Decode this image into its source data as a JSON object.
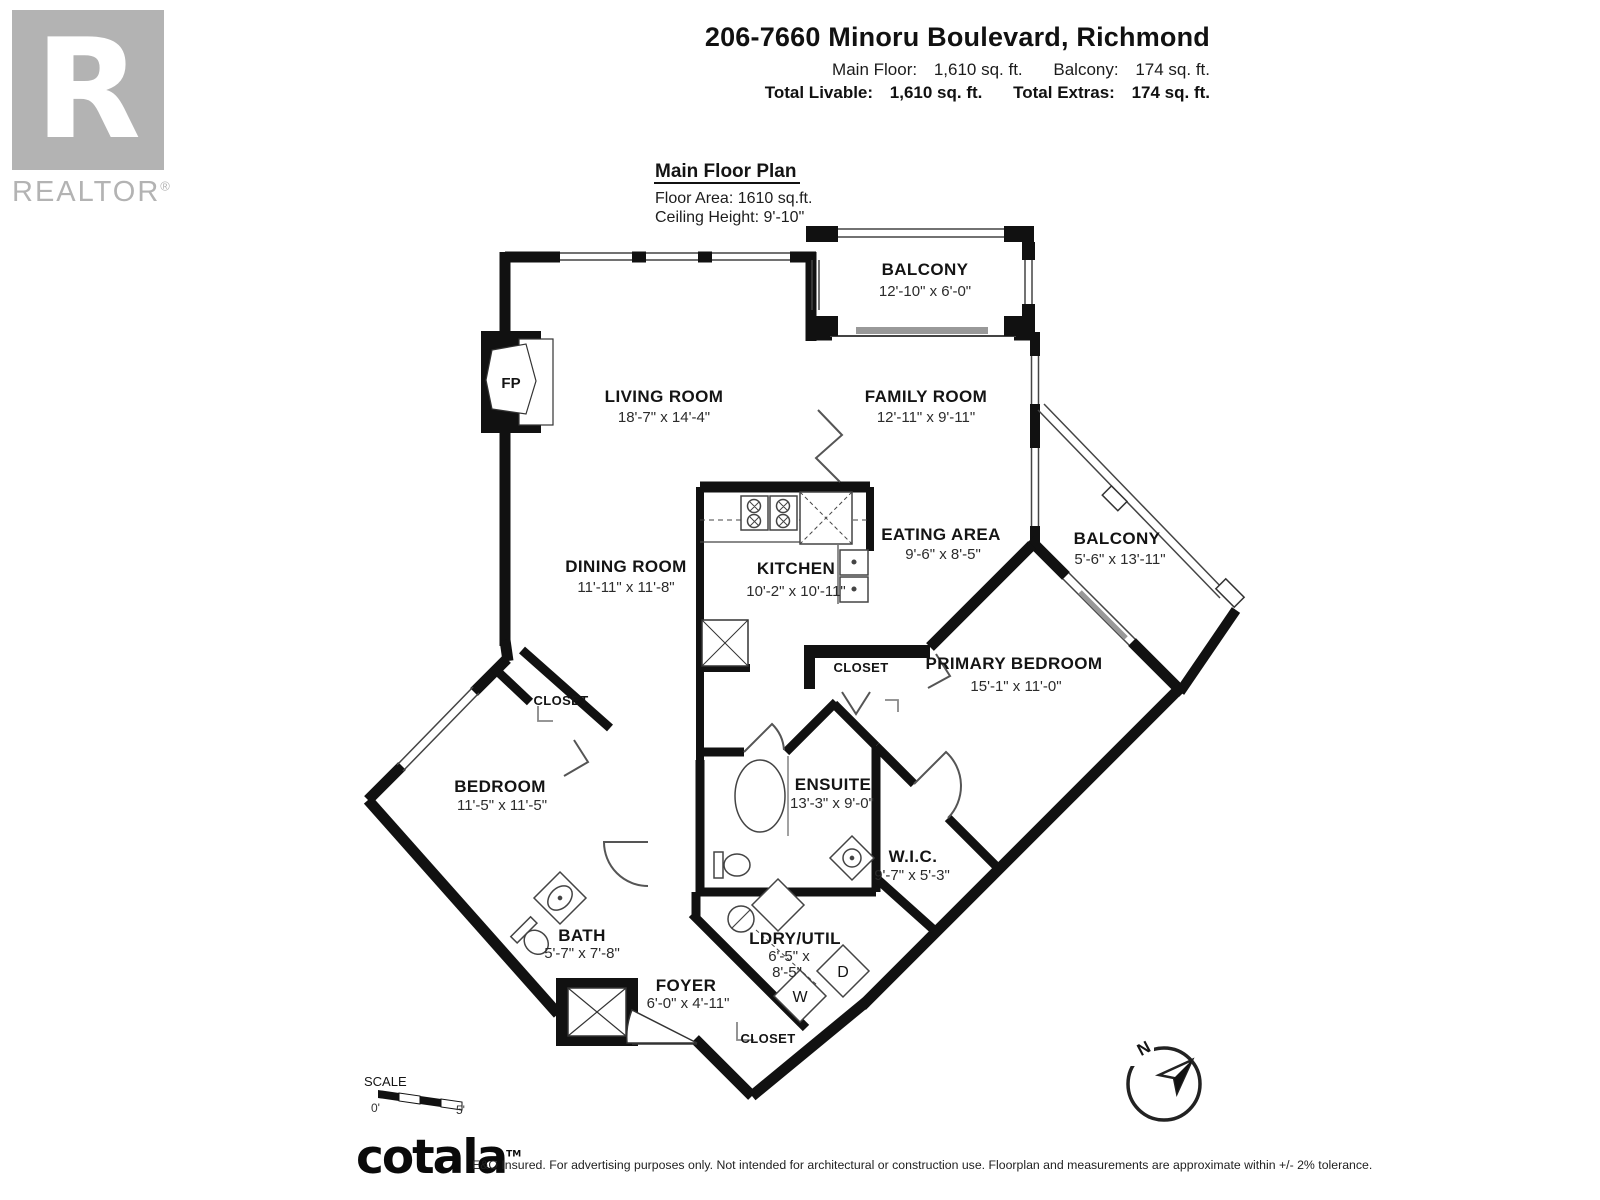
{
  "branding": {
    "realtor_logo_letter": "R",
    "realtor_logo_text": "REALTOR",
    "registered_mark": "®"
  },
  "header": {
    "address": "206-7660 Minoru Boulevard, Richmond",
    "stats": [
      {
        "label": "Main Floor:",
        "value": "1,610 sq. ft."
      },
      {
        "label": "Balcony:",
        "value": "174 sq. ft."
      }
    ],
    "totals": [
      {
        "label": "Total Livable:",
        "value": "1,610 sq. ft."
      },
      {
        "label": "Total Extras:",
        "value": "174 sq. ft."
      }
    ]
  },
  "plan": {
    "title": "Main Floor Plan",
    "floor_area": "Floor Area: 1610 sq.ft.",
    "ceiling_height": "Ceiling Height: 9'-10\"",
    "fireplace_label": "FP",
    "washer_label": "W",
    "dryer_label": "D",
    "rooms": [
      {
        "id": "living-room",
        "name": "LIVING ROOM",
        "dims": "18'-7\" x 14'-4\""
      },
      {
        "id": "dining-room",
        "name": "DINING ROOM",
        "dims": "11'-11\" x 11'-8\""
      },
      {
        "id": "kitchen",
        "name": "KITCHEN",
        "dims": "10'-2\" x 10'-11\""
      },
      {
        "id": "eating-area",
        "name": "EATING AREA",
        "dims": "9'-6\" x 8'-5\""
      },
      {
        "id": "family-room",
        "name": "FAMILY ROOM",
        "dims": "12'-11\" x 9'-11\""
      },
      {
        "id": "balcony-top",
        "name": "BALCONY",
        "dims": "12'-10\" x 6'-0\""
      },
      {
        "id": "balcony-right",
        "name": "BALCONY",
        "dims": "5'-6\" x 13'-11\""
      },
      {
        "id": "primary-bedroom",
        "name": "PRIMARY BEDROOM",
        "dims": "15'-1\" x 11'-0\""
      },
      {
        "id": "bedroom",
        "name": "BEDROOM",
        "dims": "11'-5\" x 11'-5\""
      },
      {
        "id": "ensuite",
        "name": "ENSUITE",
        "dims": "13'-3\" x 9'-0\""
      },
      {
        "id": "wic",
        "name": "W.I.C.",
        "dims": "9'-7\" x 5'-3\""
      },
      {
        "id": "bath",
        "name": "BATH",
        "dims": "5'-7\" x 7'-8\""
      },
      {
        "id": "foyer",
        "name": "FOYER",
        "dims": "6'-0\" x 4'-11\""
      },
      {
        "id": "ldry-util",
        "name": "LDRY/UTIL",
        "dims": "6'-5\" x",
        "dims2": "8'-5\""
      }
    ],
    "closets": [
      "CLOSET",
      "CLOSET",
      "CLOSET"
    ]
  },
  "scale": {
    "label": "SCALE",
    "start": "0'",
    "end": "5'"
  },
  "compass": {
    "north_label": "N"
  },
  "footer": {
    "logo": "cotala",
    "tm": "TM",
    "disclaimer": "E&O Insured. For advertising purposes only. Not intended for architectural or construction use. Floorplan and measurements are approximate within +/- 2% tolerance."
  }
}
